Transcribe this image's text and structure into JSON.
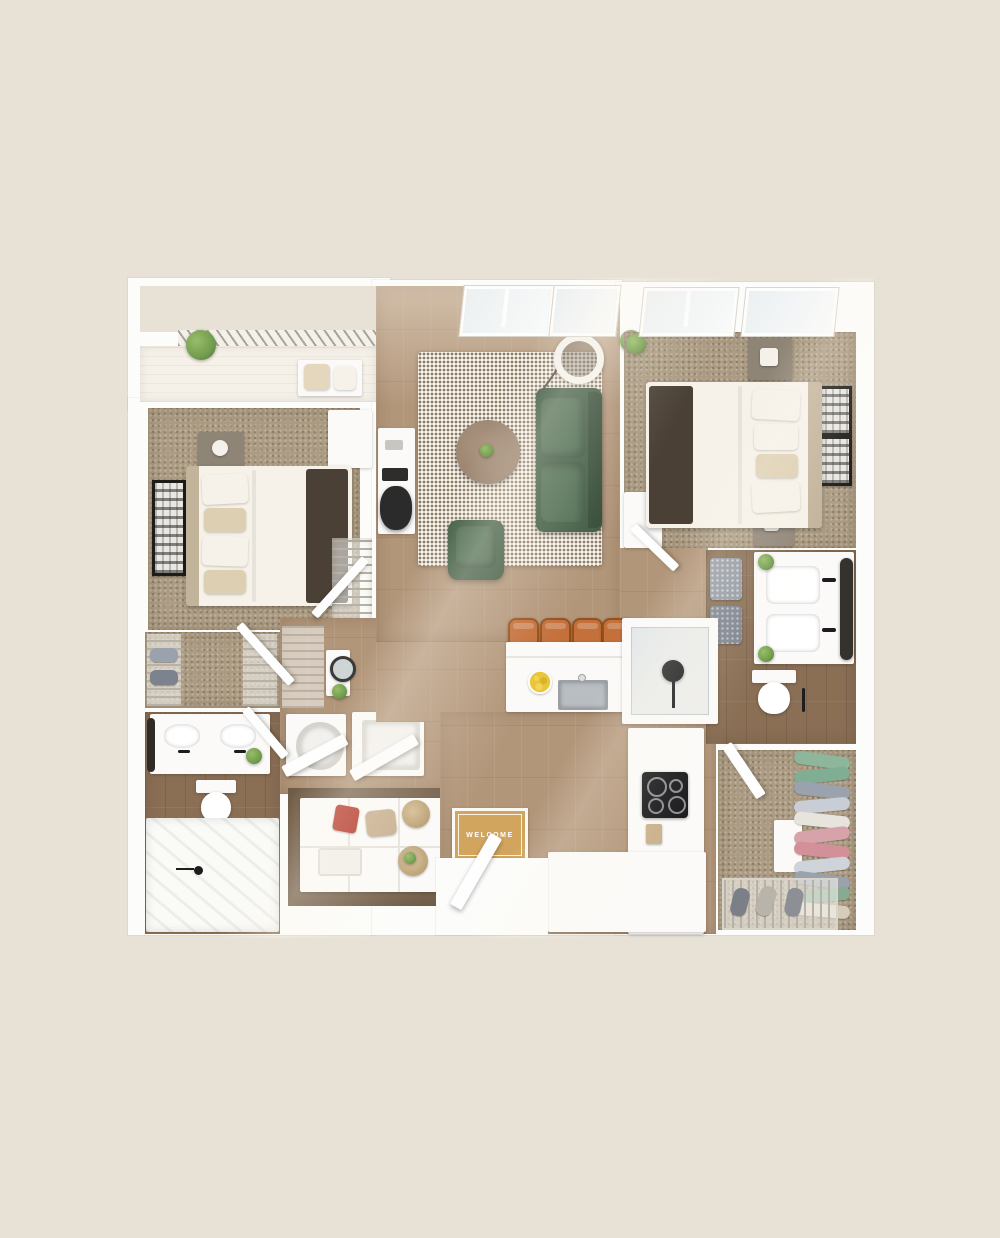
{
  "scene": {
    "type": "3d-apartment-floor-plan-render",
    "welcome_mat_text": "WELCOME"
  },
  "rooms": [
    "balcony",
    "bedroom-1",
    "living-room",
    "bedroom-2",
    "hall-closet",
    "bathroom-1",
    "hallway",
    "laundry-closet",
    "pantry",
    "kitchen",
    "entry",
    "bathroom-2",
    "walk-in-closet"
  ],
  "furniture": [
    "queen-bed",
    "nightstand",
    "wall-art",
    "area-rug",
    "sofa",
    "armchair",
    "coffee-table",
    "floor-lamp",
    "desk",
    "desk-chair",
    "kitchen-island",
    "bar-stool",
    "island-sink",
    "fruit-bowl",
    "cooktop",
    "double-vanity",
    "toilet",
    "walk-in-shower",
    "bathtub",
    "washer",
    "dryer",
    "hanging-clothes",
    "shoe-rack",
    "pantry-shelves",
    "balcony-bench",
    "potted-plant",
    "welcome-mat",
    "patterned-ottoman",
    "round-mirror"
  ],
  "colors": {
    "bg": "#e8e1d5",
    "wall": "#fcfcfa",
    "wood": "#b2967a",
    "tile": "#8a6f55",
    "carpet": "#ab9b82",
    "rug": "#dbd1c2",
    "rug-dot": "#7e7261",
    "sofa": "#3e5a41",
    "sofa-cushion": "#4c6b50",
    "stool": "#c4703a",
    "mat": "#d2a55f",
    "throw": "#4a4036",
    "linen": "#f6f2e9",
    "headboard": "#c2b39b",
    "nightstand": "#8e8577",
    "towel": "#939aa4",
    "steel": "#b9bec2",
    "fruit": "#e9c53a",
    "plant": "#6f9a4c",
    "black": "#1d1d1f",
    "chip-bag": "#b33226",
    "burlap": "#c6ae8e",
    "basket": "#b89e71",
    "cloth-green": "#8db69a",
    "cloth-gray": "#9aa2ae",
    "cloth-pink": "#d7a2aa",
    "cloth-white": "#e7e4de"
  }
}
